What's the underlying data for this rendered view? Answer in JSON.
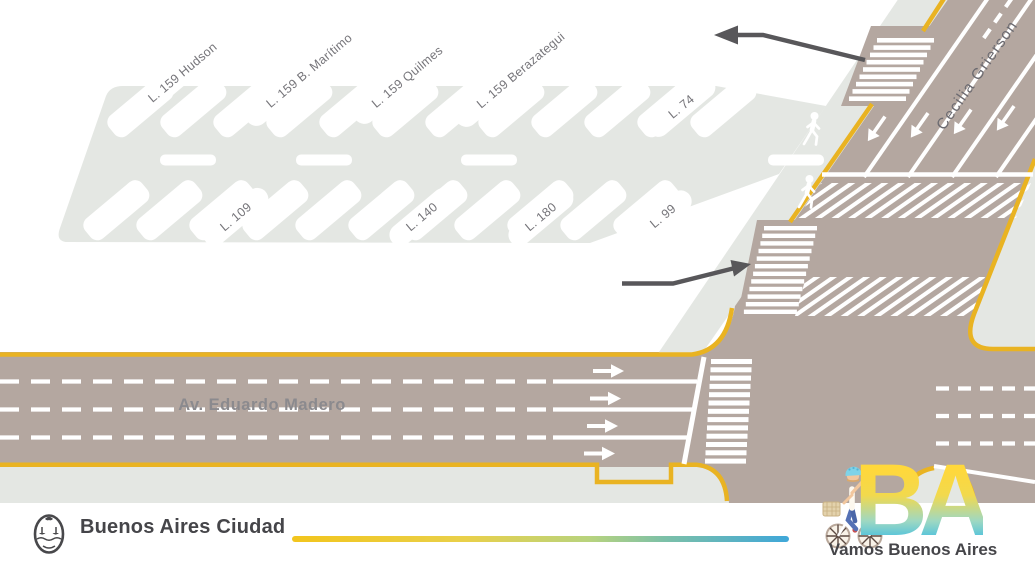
{
  "diagram": {
    "bus_stop_labels": {
      "hudson": "L. 159 Hudson",
      "maritimo": "L. 159 B. Marítimo",
      "quilmes": "L. 159 Quilmes",
      "berazategui": "L. 159 Berazategui",
      "l74": "L. 74",
      "l109": "L. 109",
      "l140": "L. 140",
      "l180": "L. 180",
      "l99": "L. 99"
    },
    "streets": {
      "madero": "Av. Eduardo Madero",
      "grierson": "Cecilia Grierson"
    },
    "icons": {
      "pedestrian": "walking-person-icon",
      "direction_arrows": "dark-direction-arrow",
      "lane_arrows": "white-lane-arrow"
    },
    "colors": {
      "road": "#b4a7a0",
      "sidewalk": "#e4e7e3",
      "curb_yellow": "#e9b322",
      "marking_white": "#ffffff",
      "arrow_dark": "#58575a",
      "label_text": "#76757a",
      "street_text": "#8b8a8e"
    }
  },
  "footer": {
    "brand": "Buenos Aires Ciudad",
    "ba_logo": "BA",
    "slogan": "Vamos Buenos Aires",
    "icons": {
      "crest": "buenos-aires-crest-icon",
      "cyclist": "cyclist-illustration"
    },
    "colors": {
      "gradient_start": "#f2c51d",
      "gradient_end": "#3fa7d9",
      "ba_yellow": "#ffd83b",
      "ba_cyan": "#2fb9e8",
      "text": "#454549"
    }
  }
}
